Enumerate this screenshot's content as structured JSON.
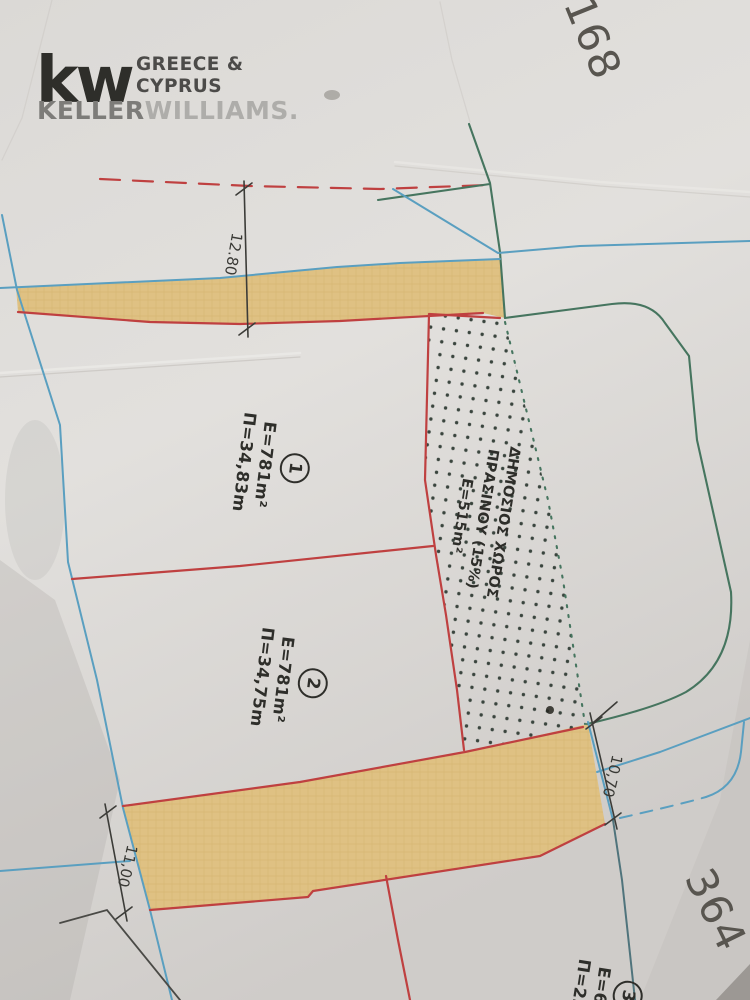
{
  "logo": {
    "kw": "kw",
    "region_line1": "GREECE &",
    "region_line2": "CYPRUS",
    "brand_bold": "KELLER",
    "brand_light": "WILLIAMS."
  },
  "parcel_numbers": {
    "top_right": "168",
    "bottom_right": "364",
    "top_partial": "7"
  },
  "plots": [
    {
      "number": "1",
      "area": "E=781m²",
      "perimeter": "Π=34,83m"
    },
    {
      "number": "2",
      "area": "E=781m²",
      "perimeter": "Π=34,75m"
    },
    {
      "number": "3",
      "area": "E=67",
      "perimeter": "Π=23,"
    }
  ],
  "green_space": {
    "line1": "ΔΗΜΟΣΙΟΣ ΧΩΡΟΣ",
    "line2": "ΠΡΑΣΙΝΟΥ (15%)",
    "line3": "Ε=515m²"
  },
  "dimensions": [
    {
      "label": "12.80"
    },
    {
      "label": "11,00"
    },
    {
      "label": "10,70"
    }
  ],
  "colors": {
    "kw_red": "#a93f44",
    "boundary_red": "#bf4040",
    "road_fill": "#dfc183",
    "road_line_blue": "#5a9fc0",
    "contour_green": "#46755f",
    "ink": "#2e2e2a",
    "paper": "#d8d6d3"
  }
}
